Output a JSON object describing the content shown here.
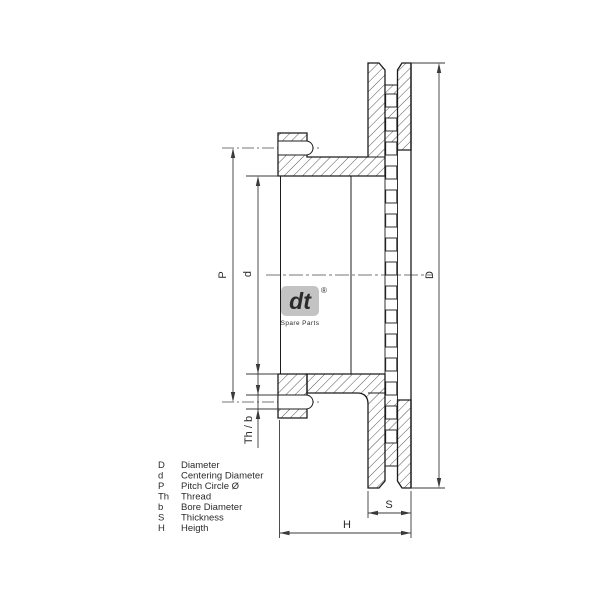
{
  "drawing": {
    "labels": {
      "P": "P",
      "d": "d",
      "D": "D",
      "S": "S",
      "H": "H",
      "thb": "Th / b"
    },
    "logo": {
      "mark": "dt",
      "reg": "®",
      "caption": "Spare Parts"
    },
    "legend": [
      {
        "symbol": "D",
        "name": "Diameter"
      },
      {
        "symbol": "d",
        "name": "Centering Diameter"
      },
      {
        "symbol": "P",
        "name": "Pitch Circle Ø"
      },
      {
        "symbol": "Th",
        "name": "Thread"
      },
      {
        "symbol": "b",
        "name": "Bore Diameter"
      },
      {
        "symbol": "S",
        "name": "Thickness"
      },
      {
        "symbol": "H",
        "name": "Heigth"
      }
    ]
  }
}
